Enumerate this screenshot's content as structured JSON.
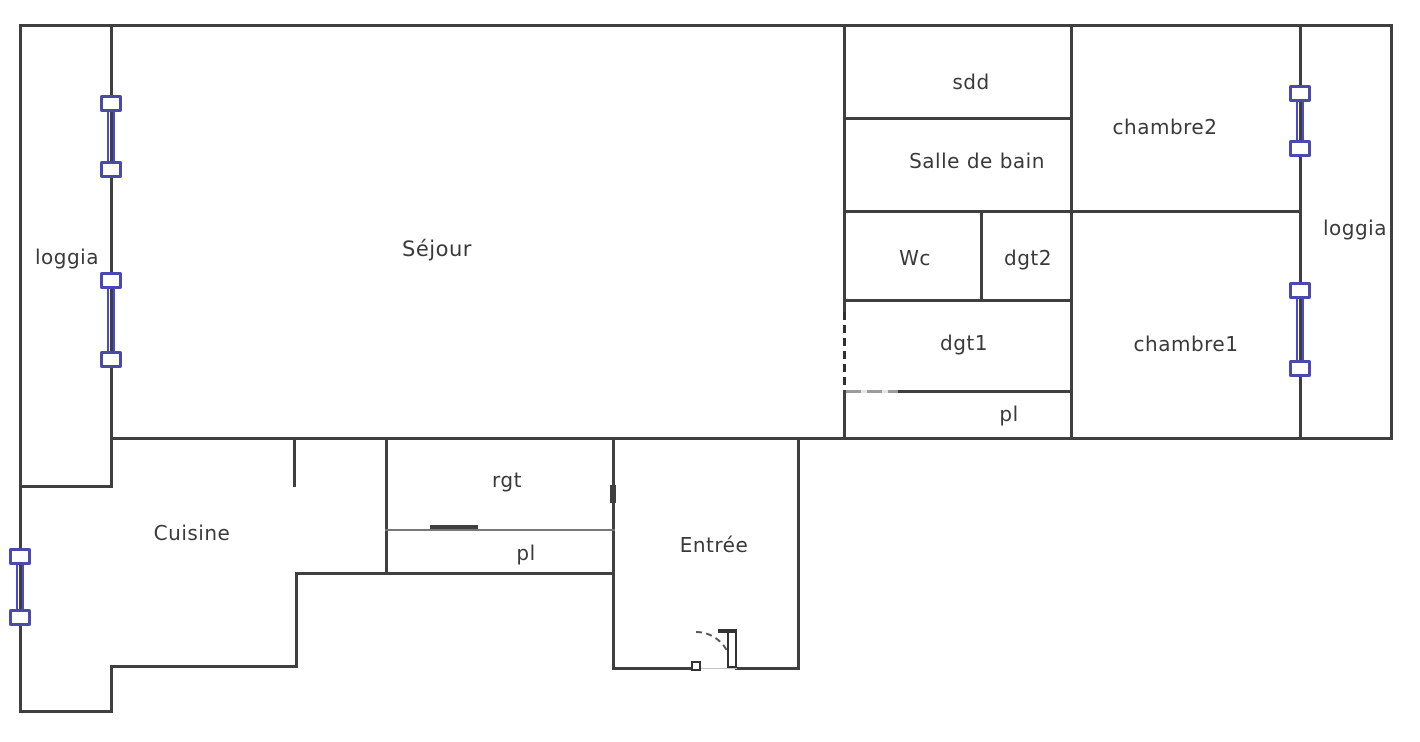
{
  "rooms": {
    "loggia_left": {
      "label": "loggia"
    },
    "sejour": {
      "label": "Séjour"
    },
    "cuisine": {
      "label": "Cuisine"
    },
    "rgt": {
      "label": "rgt"
    },
    "pl_bottom": {
      "label": "pl"
    },
    "entree": {
      "label": "Entrée"
    },
    "sdd": {
      "label": "sdd"
    },
    "salle_de_bain": {
      "label": "Salle de bain"
    },
    "wc": {
      "label": "Wc"
    },
    "dgt2": {
      "label": "dgt2"
    },
    "dgt1": {
      "label": "dgt1"
    },
    "pl_top": {
      "label": "pl"
    },
    "chambre2": {
      "label": "chambre2"
    },
    "chambre1": {
      "label": "chambre1"
    },
    "loggia_right": {
      "label": "loggia"
    }
  },
  "colors": {
    "wall": "#3f3f3f",
    "wall_light": "#787878",
    "window_frame": "#4a4aae",
    "window_glass": "#4848d2",
    "text": "#3a3a3a",
    "background": "#ffffff"
  }
}
